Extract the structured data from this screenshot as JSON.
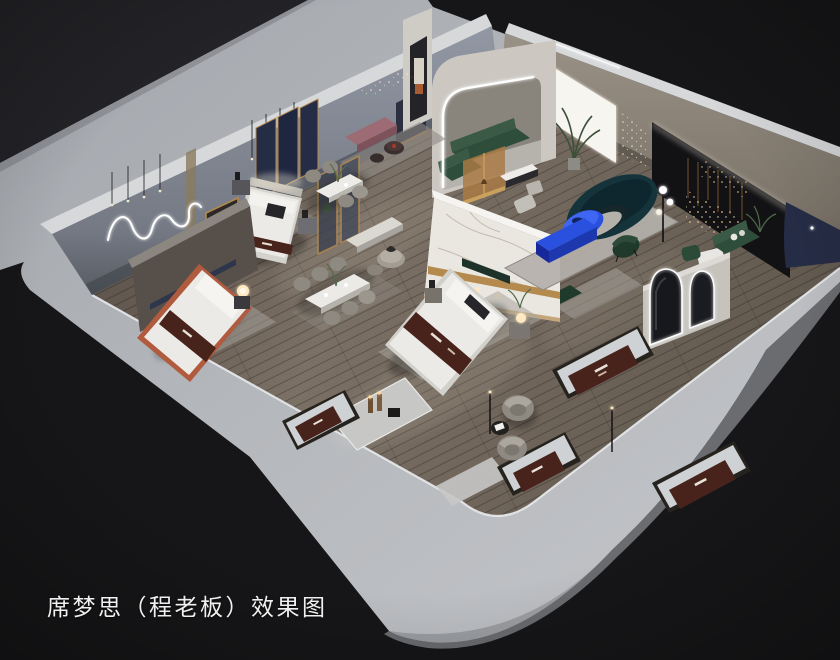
{
  "title": "席梦思（程老板）效果图",
  "caption": {
    "text": "席梦思（程老板）效果图"
  },
  "scene": {
    "kind": "3d-interior-showroom-rendering",
    "objects": [
      "exterior-plinth",
      "outer-wall-band",
      "showroom-floor",
      "back-left-wall",
      "neon-squiggle-light",
      "pendant-lights",
      "back-right-wall",
      "backlit-panel",
      "dark-display-wall",
      "fairy-lights",
      "navy-wall-panel",
      "arch-feature-wall",
      "led-arch-strip",
      "green-sectional-sofa",
      "wood-glass-screen",
      "arched-mirror-partition",
      "bed-display",
      "dining-set",
      "curved-teal-sofa",
      "blue-coffee-table",
      "blue-media-console",
      "green-accent-chair",
      "globe-floor-lamp",
      "swivel-armchairs",
      "display-mattress",
      "marble-partition",
      "gold-glass-partition",
      "floor-mirror",
      "pink-bench",
      "mattress-platform"
    ]
  },
  "palette": {
    "bg": "#161618",
    "bg_corner": "#232327",
    "band_dark": "#9da0a6",
    "band_mid": "#b2b5b9",
    "band_light": "#c6c8cc",
    "wall_top_edge": "#d6d8da",
    "wall_left_hi": "#9096a1",
    "wall_left_lo": "#5d6169",
    "wall_right_hi": "#978f83",
    "wall_right_lo": "#6e675d",
    "floor_dark": "#564d45",
    "floor_mid": "#7b7065",
    "floor_right": "#645b51",
    "floor_lip": "#e4e6e8",
    "bed_white": "#eceae6",
    "runner": "#47231c",
    "silver": "#cfd2d5",
    "gold": "#b48a4e",
    "navy": "#252c45",
    "marble": "#eae7e1",
    "blue": "#2a50e0",
    "blue_dark": "#1d38ae",
    "teal": "#14333b",
    "green_sofa": "#2e4d3a",
    "green_chair": "#1f3a2b",
    "amber": "#aa7a45",
    "pink": "#9c6b74",
    "rug": "#b4b0aa",
    "gray_chair": "#8e8981",
    "platform_marble": "#c7c7c5",
    "mattress_platform": "#26231f",
    "lamp_warm": "#ffd9a0",
    "led": "#ffffff"
  }
}
